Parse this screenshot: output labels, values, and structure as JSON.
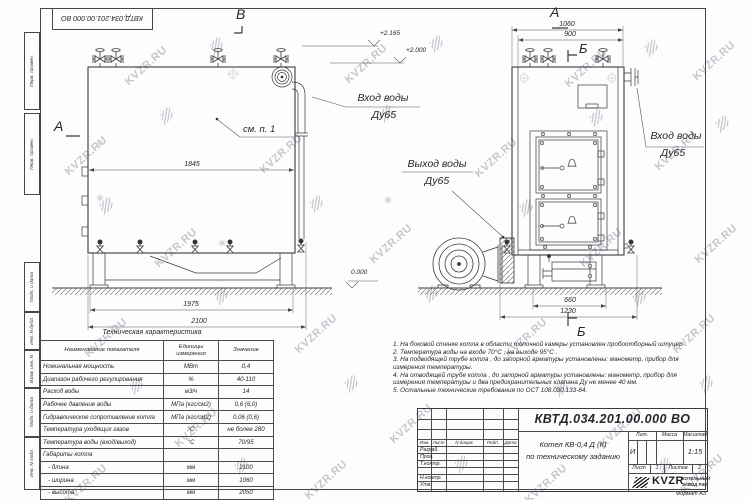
{
  "watermark": {
    "text": "KVZR.RU"
  },
  "frame": {
    "inverted_stamp": "КВТД.034.201.00.000  ВО",
    "margin_top": [
      "Перв. примен.",
      "Перв. примен."
    ],
    "margin_bottom": [
      "Подп. и дата",
      "Инв. N дубл.",
      "Взам. инв. N",
      "Подп. и дата",
      "Инв. N подл."
    ],
    "format_note": "Формат  А3"
  },
  "views": {
    "side": {
      "label": "В",
      "section_marker": "А",
      "see_note": "см. п. 1",
      "dim_width": "1845",
      "dim_base": "1975",
      "dim_overall": "2100",
      "lvl_top": "+2.165",
      "lvl_mid": "+2.000",
      "lvl_ground": "0.000",
      "inlet1": "Вход воды",
      "inlet2": "Ду65"
    },
    "front": {
      "label": "А",
      "marker_top": "Б",
      "marker_bottom": "Б",
      "dim_outer": "1060",
      "dim_inner": "900",
      "dim_base": "660",
      "dim_overall": "1230",
      "inlet1": "Вход воды",
      "inlet2": "Ду65",
      "outlet1": "Выход воды",
      "outlet2": "Ду65"
    }
  },
  "table": {
    "title": "Техническая характеристика",
    "headers": [
      "Наименование показателя",
      "Единицы измерения",
      "Значение"
    ],
    "rows": [
      [
        "Номинальная мощность",
        "МВт",
        "0,4"
      ],
      [
        "Диапазон рабочего регулирования",
        "%",
        "40-110"
      ],
      [
        "Расход воды",
        "м3/ч",
        "14"
      ],
      [
        "Рабочее давление воды",
        "МПа (кгс/см2)",
        "0,6 (6,0)"
      ],
      [
        "Гидравлическое сопротивление котла",
        "МПа (кгс/см2)",
        "0,06 (0,6)"
      ],
      [
        "Температура уходящих газов",
        "°С",
        "не более 280"
      ],
      [
        "Температура воды (вход/выход)",
        "°С",
        "70/95"
      ],
      [
        "Габариты котла",
        "",
        ""
      ],
      [
        "   - длина",
        "мм",
        "2100"
      ],
      [
        "   - ширина",
        "мм",
        "1060"
      ],
      [
        "   - высота",
        "мм",
        "2050"
      ]
    ]
  },
  "notes": [
    "1.  На боковой стенке котла в области топочной камеры установлен пробоотборный штуцер",
    "2.  Температура воды на входе  70°С , на выходе  95°С .",
    "3.  На подводящей трубе котла , до запорной арматуры установлены:  манометр,  прибор для измерения температуры.",
    "4.  На отводящей трубе котла , до запорной арматуры установлены:  манометр,  прибор для измерения температуры и два предохранительных клапана  Ду не менее  40 мм.",
    "5.  Остальные технические требования по ОСТ  108.030.133-84."
  ],
  "title_block": {
    "doc_number": "КВТД.034.201.00.000  ВО",
    "name_line1": "Котел  КВ-0,4  Д  (К)",
    "name_line2": "по техническому заданию",
    "lit_label": "Лит.",
    "mass_label": "Масса",
    "scale_label": "Масштаб",
    "lit_value": "И",
    "scale_value": "1:15",
    "sheet_label": "Лист",
    "sheet_value": "1",
    "sheets_label": "Листов",
    "sheets_value": "2",
    "rev_headers": [
      "Изм.",
      "Лист",
      "N докум.",
      "Подп.",
      "Дата"
    ],
    "roles": [
      "Разраб.",
      "Пров.",
      "Т.контр.",
      "",
      "Н.контр.",
      "Утв."
    ],
    "logo_text": "KVZR",
    "company_line1": "КОТЕЛЬНЫЙ",
    "company_line2": "ЗАВОД РЭП"
  }
}
